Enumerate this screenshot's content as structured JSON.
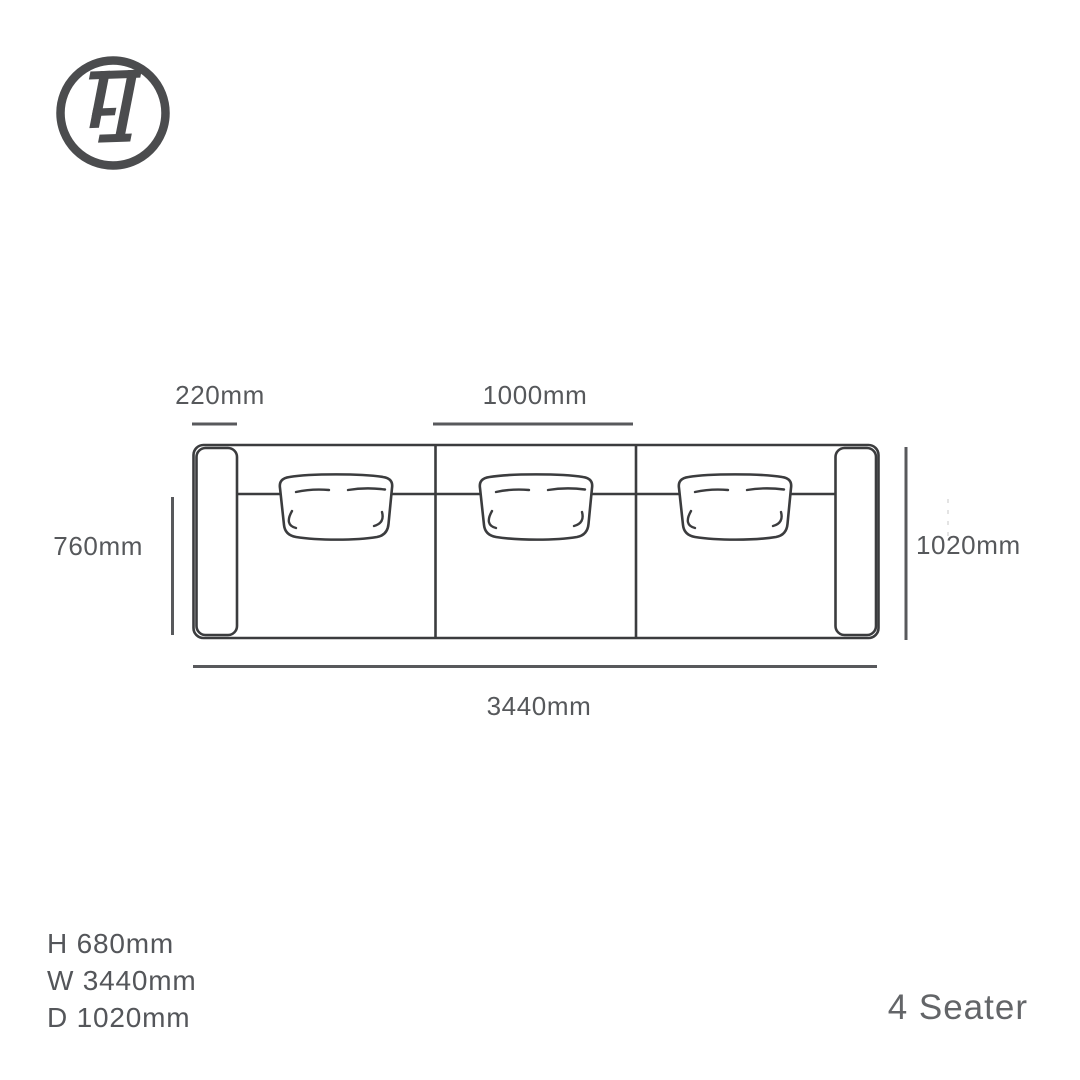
{
  "brand": {
    "monogram": "FI"
  },
  "diagram": {
    "title": "sofa top view dimension drawing",
    "annotations": {
      "arm_width": "220mm",
      "seat_width": "1000mm",
      "seat_depth": "760mm",
      "overall_depth": "1020mm",
      "overall_width": "3440mm"
    }
  },
  "specs": {
    "height": "H 680mm",
    "width": "W 3440mm",
    "depth": "D 1020mm"
  },
  "variant": {
    "label": "4 Seater"
  },
  "colors": {
    "background": "#ffffff",
    "outline": "#3b3c3e",
    "dimension_line": "#58595c",
    "text": "#55575a",
    "logo": "#4b4c4e"
  }
}
